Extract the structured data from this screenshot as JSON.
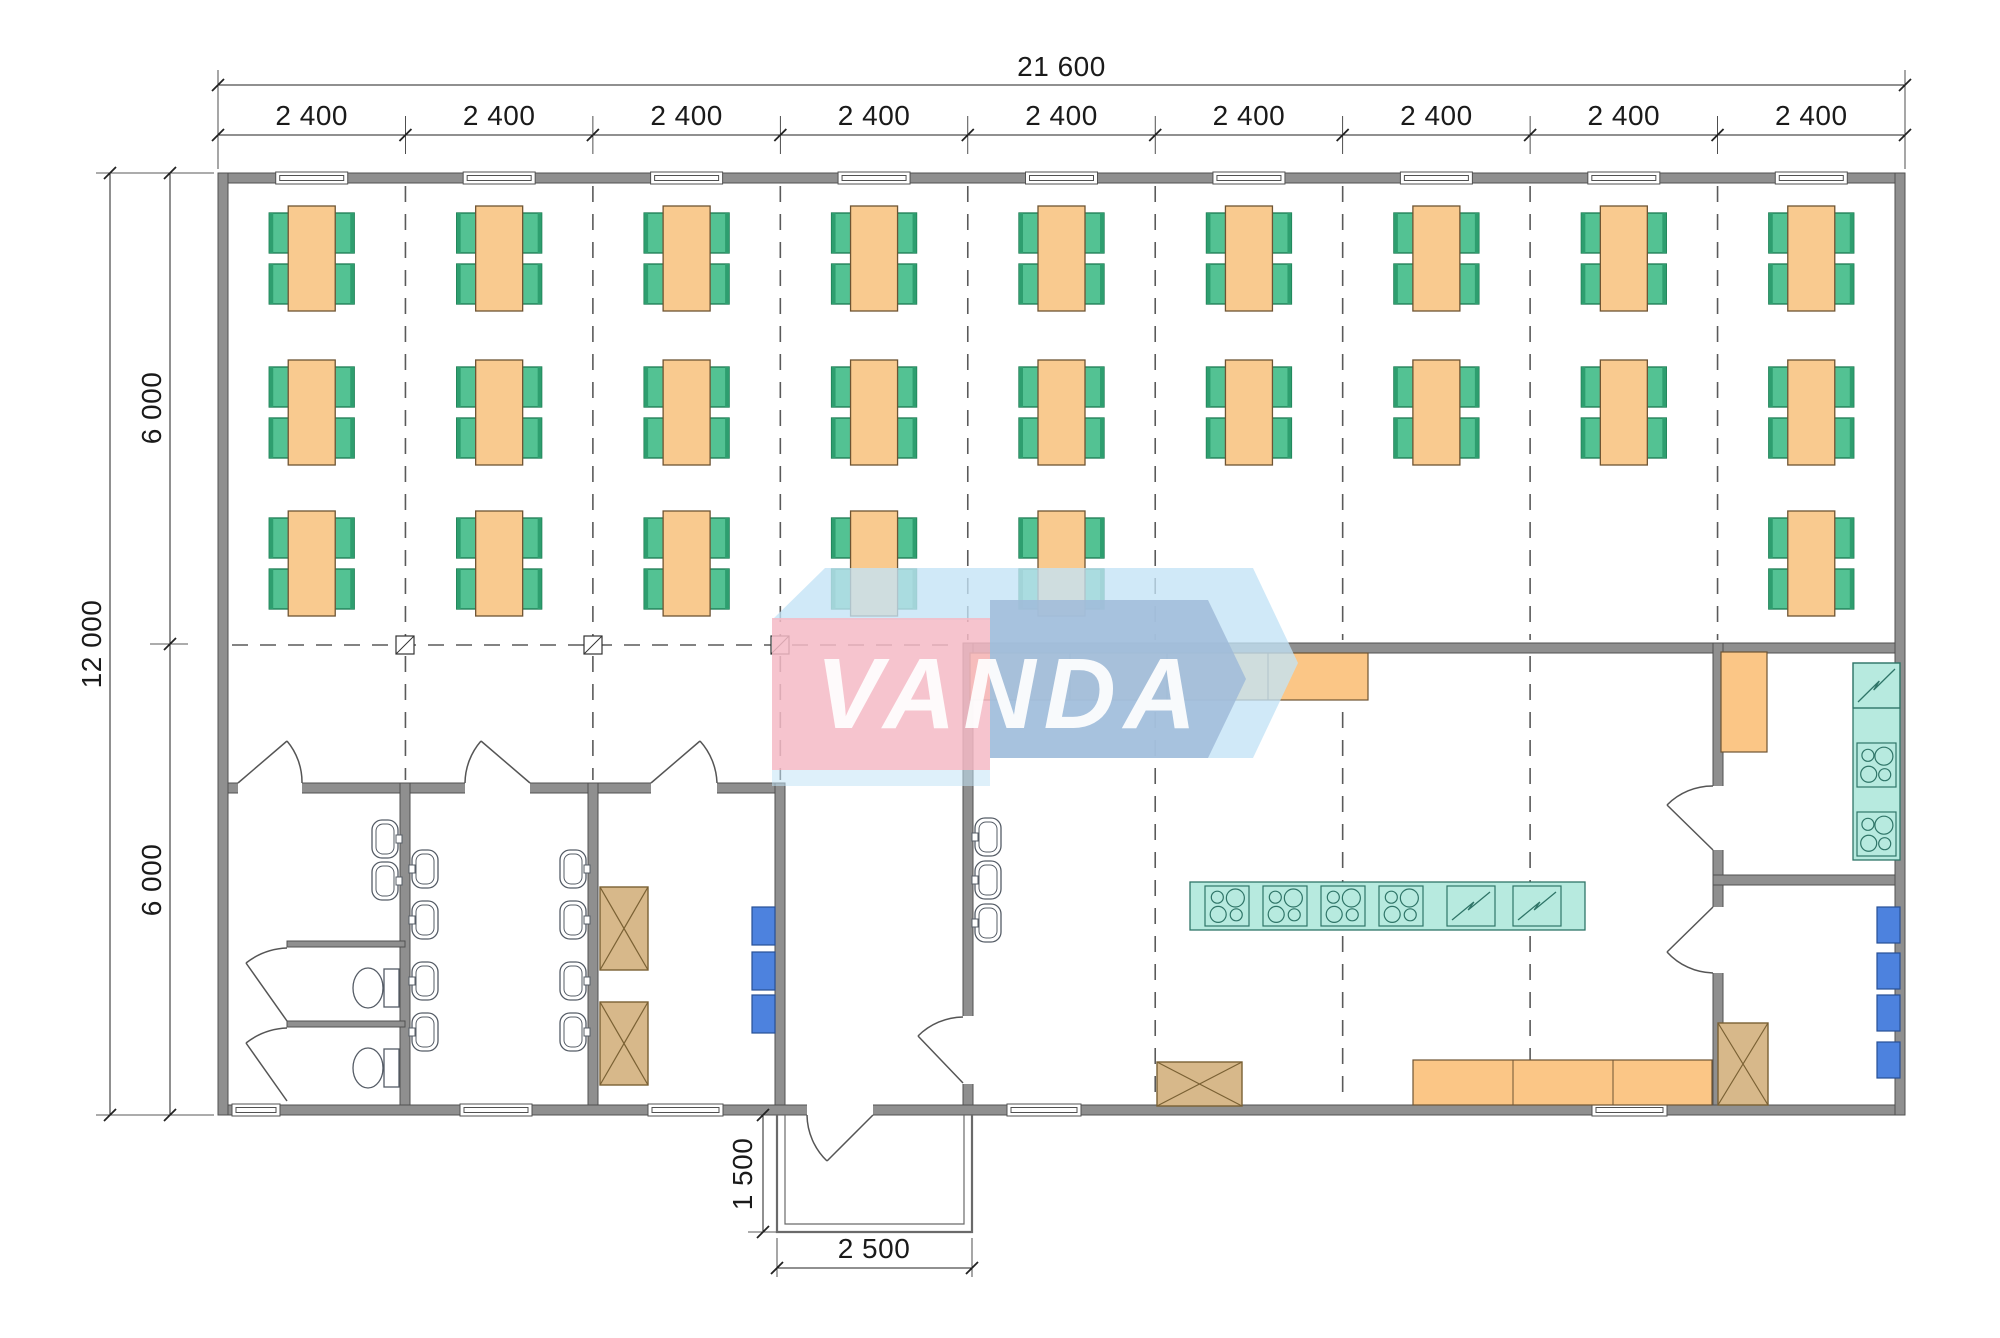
{
  "watermark": {
    "text": "VANDA",
    "panel_pink": "#F5BAC6",
    "panel_blue": "#A0BBD9",
    "backdrop_blue": "#C3E3F6"
  },
  "dimensions": {
    "top_total": "21 600",
    "top_segments": [
      "2 400",
      "2 400",
      "2 400",
      "2 400",
      "2 400",
      "2 400",
      "2 400",
      "2 400",
      "2 400"
    ],
    "left_total": "12 000",
    "left_segments": [
      "6 000",
      "6 000"
    ],
    "porch_depth": "1 500",
    "porch_width": "2 500"
  },
  "structure": {
    "bay_count": 9,
    "dining_rows": [
      {
        "row": 1,
        "bays_with_tables": [
          1,
          2,
          3,
          4,
          5,
          6,
          7,
          8,
          9
        ]
      },
      {
        "row": 2,
        "bays_with_tables": [
          1,
          2,
          3,
          4,
          5,
          6,
          7,
          8,
          9
        ]
      },
      {
        "row": 3,
        "bays_with_tables": [
          1,
          2,
          3,
          4,
          5,
          9
        ]
      }
    ],
    "seats_per_table": 4
  },
  "inventory": {
    "dining_tables": 24,
    "chairs": 96,
    "toilets": 2,
    "wash_basins": 13,
    "cooktop_units": 6,
    "cooler_units": 3,
    "crates": 4,
    "blue_cabinets": 7,
    "windows_top": 9,
    "windows_bottom": 5
  },
  "colors": {
    "wall": "#8F8F8F",
    "wall_edge": "#515151",
    "table": "#F9CA8F",
    "table_edge": "#6E5433",
    "chair": "#53C293",
    "chair_dark": "#2E9E6F",
    "chair_edge": "#1A7A50",
    "counter": "#FBC686",
    "teal": "#B7EADF",
    "teal_edge": "#2F7568",
    "blue_unit": "#4D82DE",
    "blue_unit_edge": "#274F96",
    "crate": "#D7B88A",
    "crate_edge": "#7A6134",
    "fixture_edge": "#555C66",
    "grid": "#5A5A5A",
    "dimension": "#222222",
    "door": "#555555",
    "porch": "#6A6A6A"
  }
}
